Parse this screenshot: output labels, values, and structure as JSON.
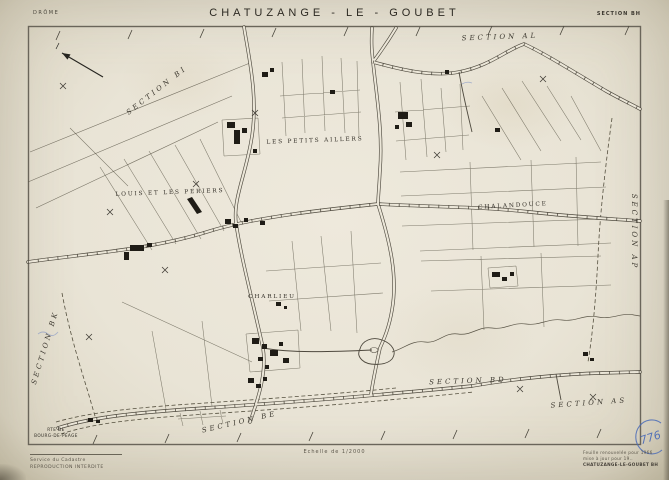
{
  "header": {
    "department": "DRÔME",
    "title": "CHATUZANGE - LE - GOUBET",
    "section_ref": "SECTION BH"
  },
  "map": {
    "sections": [
      "SECTION BI",
      "SECTION AL",
      "SECTION BK",
      "SECTION AP",
      "SECTION BD",
      "SECTION AS",
      "SECTION BE"
    ],
    "lieux_dits": [
      "LES PETITS AILLERS",
      "LOUIS ET LES PERIERS",
      "CHALANDOUCE",
      "CHARLIEU"
    ],
    "road_sign": {
      "line1": "RTE DE",
      "line2": "BOURG-DE-PÉAGE"
    },
    "icons": {
      "north_arrow": "north-arrow-icon"
    },
    "colors": {
      "paper": "#e9e4d6",
      "ink": "#4e493e",
      "building": "#1f1c16",
      "annotation_blue": "#3f63b8"
    },
    "handwritten_number": "776"
  },
  "footer": {
    "scale": "Echelle de 1/2000",
    "left_line1": "Service du Cadastre",
    "left_line2": "REPRODUCTION INTERDITE",
    "right_line1": "Feuille renouvelée pour 1966",
    "right_line2": "mise à jour pour 19..",
    "right_line3": "CHATUZANGE-LE-GOUBET  BH"
  }
}
